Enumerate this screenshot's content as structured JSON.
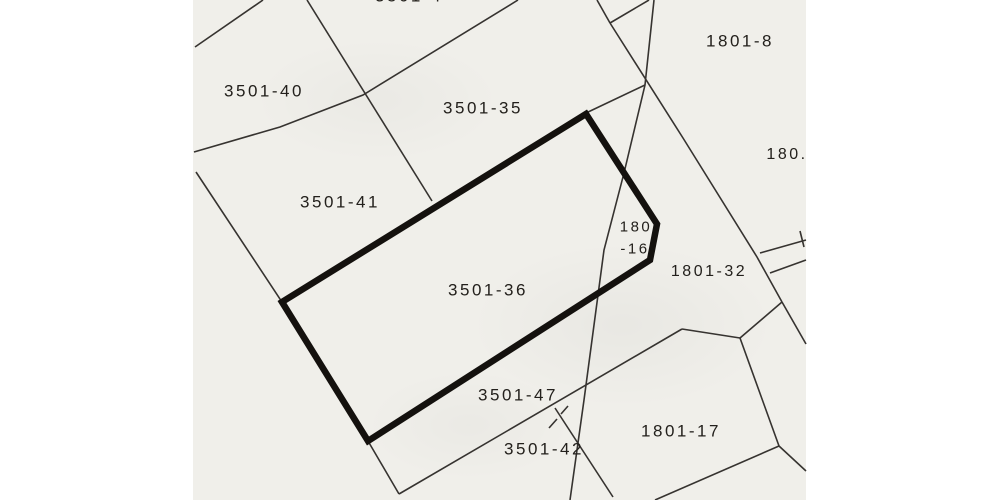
{
  "map": {
    "description": "scanned cadastral parcel map",
    "scan": {
      "left": 193,
      "width": 613,
      "paper_color": "#ffffff",
      "sheet_color": "#f0efea"
    },
    "ink": {
      "thin_color": "#363330",
      "bold_color": "#14110e",
      "text_color": "#23201c",
      "thin_width": 1.6,
      "bold_width": 6.5
    },
    "highlighted_parcel": {
      "id": "3501-36",
      "outline": [
        [
          282,
          302
        ],
        [
          586,
          114
        ],
        [
          657,
          224
        ],
        [
          650,
          260
        ],
        [
          368,
          441
        ]
      ]
    },
    "labels": [
      {
        "id": "3501-4-clipped-top",
        "text": "3501-4",
        "x": 409,
        "y": -4,
        "size": 17
      },
      {
        "id": "3501-40",
        "text": "3501-40",
        "x": 264,
        "y": 91,
        "size": 17
      },
      {
        "id": "3501-35",
        "text": "3501-35",
        "x": 483,
        "y": 108,
        "size": 17
      },
      {
        "id": "3501-41",
        "text": "3501-41",
        "x": 340,
        "y": 202,
        "size": 17
      },
      {
        "id": "3501-36",
        "text": "3501-36",
        "x": 488,
        "y": 290,
        "size": 17
      },
      {
        "id": "3501-47",
        "text": "3501-47",
        "x": 518,
        "y": 395,
        "size": 17
      },
      {
        "id": "3501-42",
        "text": "3501-42",
        "x": 544,
        "y": 449,
        "size": 17
      },
      {
        "id": "1801-8",
        "text": "1801-8",
        "x": 740,
        "y": 41,
        "size": 17
      },
      {
        "id": "180-clipped-right",
        "text": "180.",
        "x": 787,
        "y": 155,
        "size": 16
      },
      {
        "id": "1801-16-line1",
        "text": "180",
        "x": 636,
        "y": 227,
        "size": 15
      },
      {
        "id": "1801-16-line2",
        "text": "-16",
        "x": 635,
        "y": 249,
        "size": 15
      },
      {
        "id": "1801-32",
        "text": "1801-32",
        "x": 709,
        "y": 272,
        "size": 16
      },
      {
        "id": "1801-17",
        "text": "1801-17",
        "x": 681,
        "y": 431,
        "size": 17
      }
    ],
    "thin_lines": [
      [
        [
          195,
          47
        ],
        [
          263,
          0
        ]
      ],
      [
        [
          194,
          152
        ],
        [
          280,
          127
        ],
        [
          363,
          95
        ],
        [
          518,
          0
        ]
      ],
      [
        [
          307,
          0
        ],
        [
          432,
          201
        ]
      ],
      [
        [
          196,
          172
        ],
        [
          282,
          302
        ],
        [
          368,
          441
        ],
        [
          399,
          494
        ]
      ],
      [
        [
          399,
          494
        ],
        [
          682,
          329
        ]
      ],
      [
        [
          682,
          329
        ],
        [
          740,
          338
        ]
      ],
      [
        [
          740,
          338
        ],
        [
          779,
          446
        ]
      ],
      [
        [
          779,
          446
        ],
        [
          655,
          500
        ]
      ],
      [
        [
          779,
          446
        ],
        [
          806,
          471
        ]
      ],
      [
        [
          654,
          0
        ],
        [
          645,
          85
        ],
        [
          624,
          173
        ],
        [
          604,
          250
        ],
        [
          596,
          310
        ],
        [
          584,
          400
        ],
        [
          570,
          500
        ]
      ],
      [
        [
          610,
          23
        ],
        [
          683,
          138
        ],
        [
          757,
          257
        ],
        [
          782,
          302
        ]
      ],
      [
        [
          597,
          0
        ],
        [
          610,
          23
        ]
      ],
      [
        [
          649,
          0
        ],
        [
          610,
          23
        ]
      ],
      [
        [
          782,
          302
        ],
        [
          806,
          344
        ]
      ],
      [
        [
          782,
          302
        ],
        [
          740,
          338
        ]
      ],
      [
        [
          760,
          253
        ],
        [
          806,
          240
        ]
      ],
      [
        [
          770,
          273
        ],
        [
          806,
          260
        ]
      ],
      [
        [
          800,
          231
        ],
        [
          804,
          247
        ]
      ],
      [
        [
          555,
          408
        ],
        [
          613,
          497
        ]
      ],
      [
        [
          586,
          113
        ],
        [
          645,
          85
        ]
      ]
    ],
    "dashed_segments": [
      [
        [
          549,
          428
        ],
        [
          557,
          419
        ]
      ],
      [
        [
          561,
          414
        ],
        [
          568,
          406
        ]
      ]
    ]
  }
}
